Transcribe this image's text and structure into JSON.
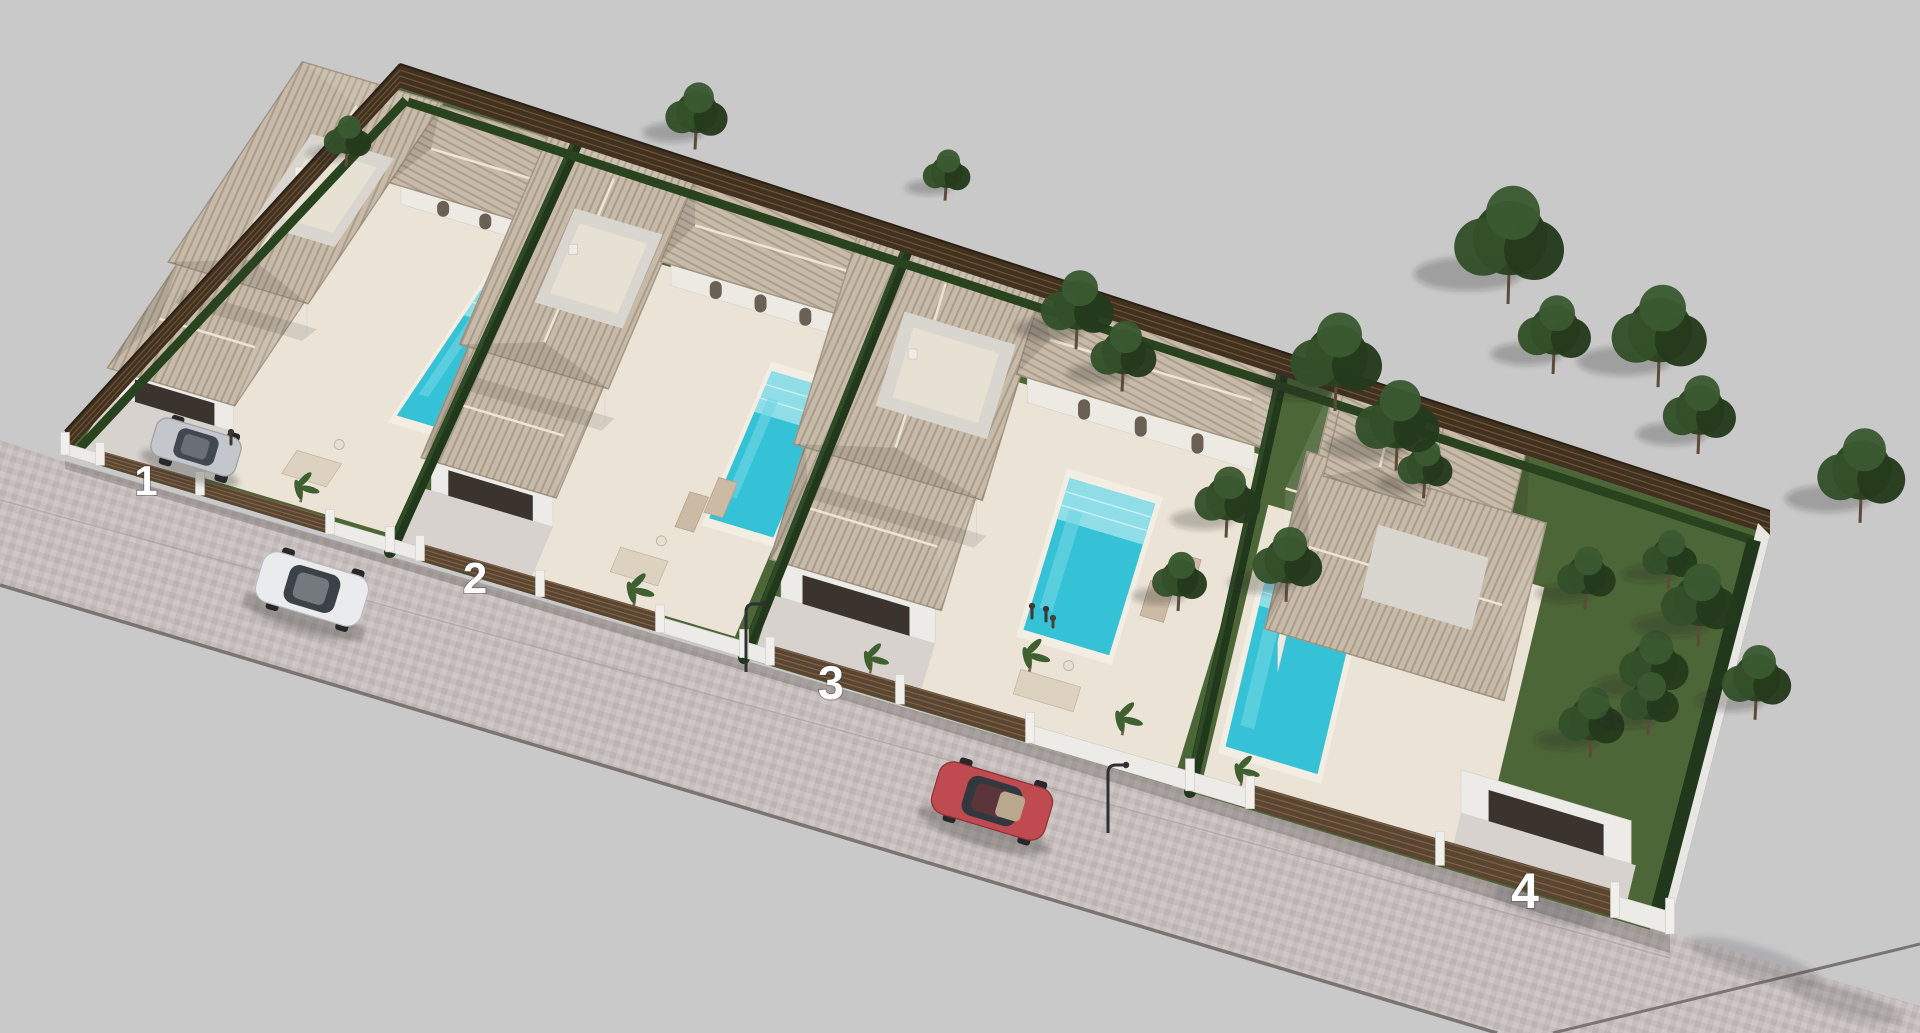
{
  "scene": {
    "kind": "3D aerial architectural render",
    "subject": "Gated residential development of four detached single-storey villas with private pools, landscaped gardens, perimeter fence and cobbled street"
  },
  "plots": [
    {
      "number": "1"
    },
    {
      "number": "2"
    },
    {
      "number": "3"
    },
    {
      "number": "4"
    }
  ],
  "palette": {
    "background": "#c9c9c9",
    "street_paving": "#c6bebc",
    "terrace": "#ebe4d6",
    "lawn": "#4d6637",
    "hedge": "#22381c",
    "wood_fence": "#41311f",
    "white_wall": "#ecebe7",
    "roof_tile": "#c7baa8",
    "pool_water": "#35c2d6",
    "pool_steps": "#9fe2ea",
    "white_car": "#e9ebed",
    "silver_car": "#c3c6ca",
    "red_car": "#bf4a50",
    "tree_foliage": "#2c4226"
  }
}
